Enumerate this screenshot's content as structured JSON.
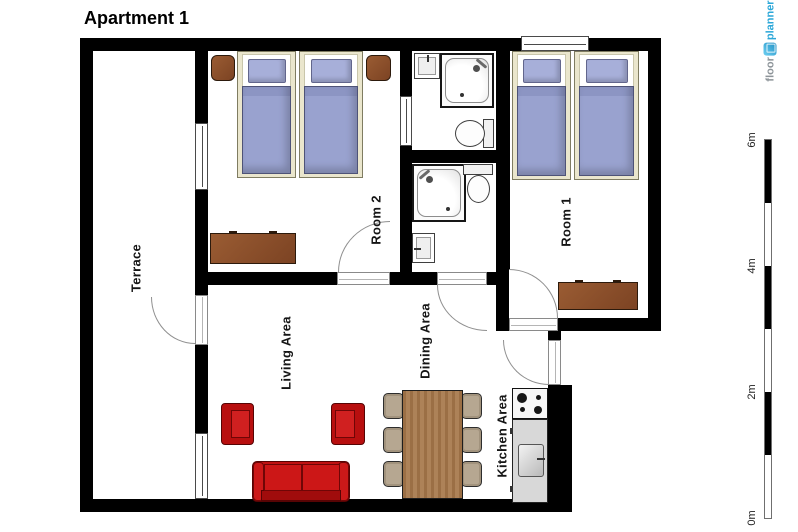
{
  "title": "Apartment 1",
  "logo": {
    "floor": "floor",
    "planner": "planner"
  },
  "rooms": {
    "room1": "Room 1",
    "room2": "Room 2",
    "terrace": "Terrace",
    "living": "Living Area",
    "dining": "Dining Area",
    "kitchen": "Kitchen Area"
  },
  "scale_ruler": {
    "unit": "m",
    "max_meters": 6,
    "labels": [
      "0m",
      "2m",
      "4m",
      "6m"
    ]
  },
  "colors": {
    "wall": "#000000",
    "bed_blanket": "#99a2cf",
    "bed_pillow": "#a7afd9",
    "bed_frame": "#eae6cd",
    "sofa_red": "#c01212",
    "wood_dark": "#8a512f",
    "wood_table": "#a87a4e",
    "dining_chair": "#b6a791",
    "kitchen_counter": "#d8d8d8",
    "logo_blue": "#2ba7d8"
  }
}
